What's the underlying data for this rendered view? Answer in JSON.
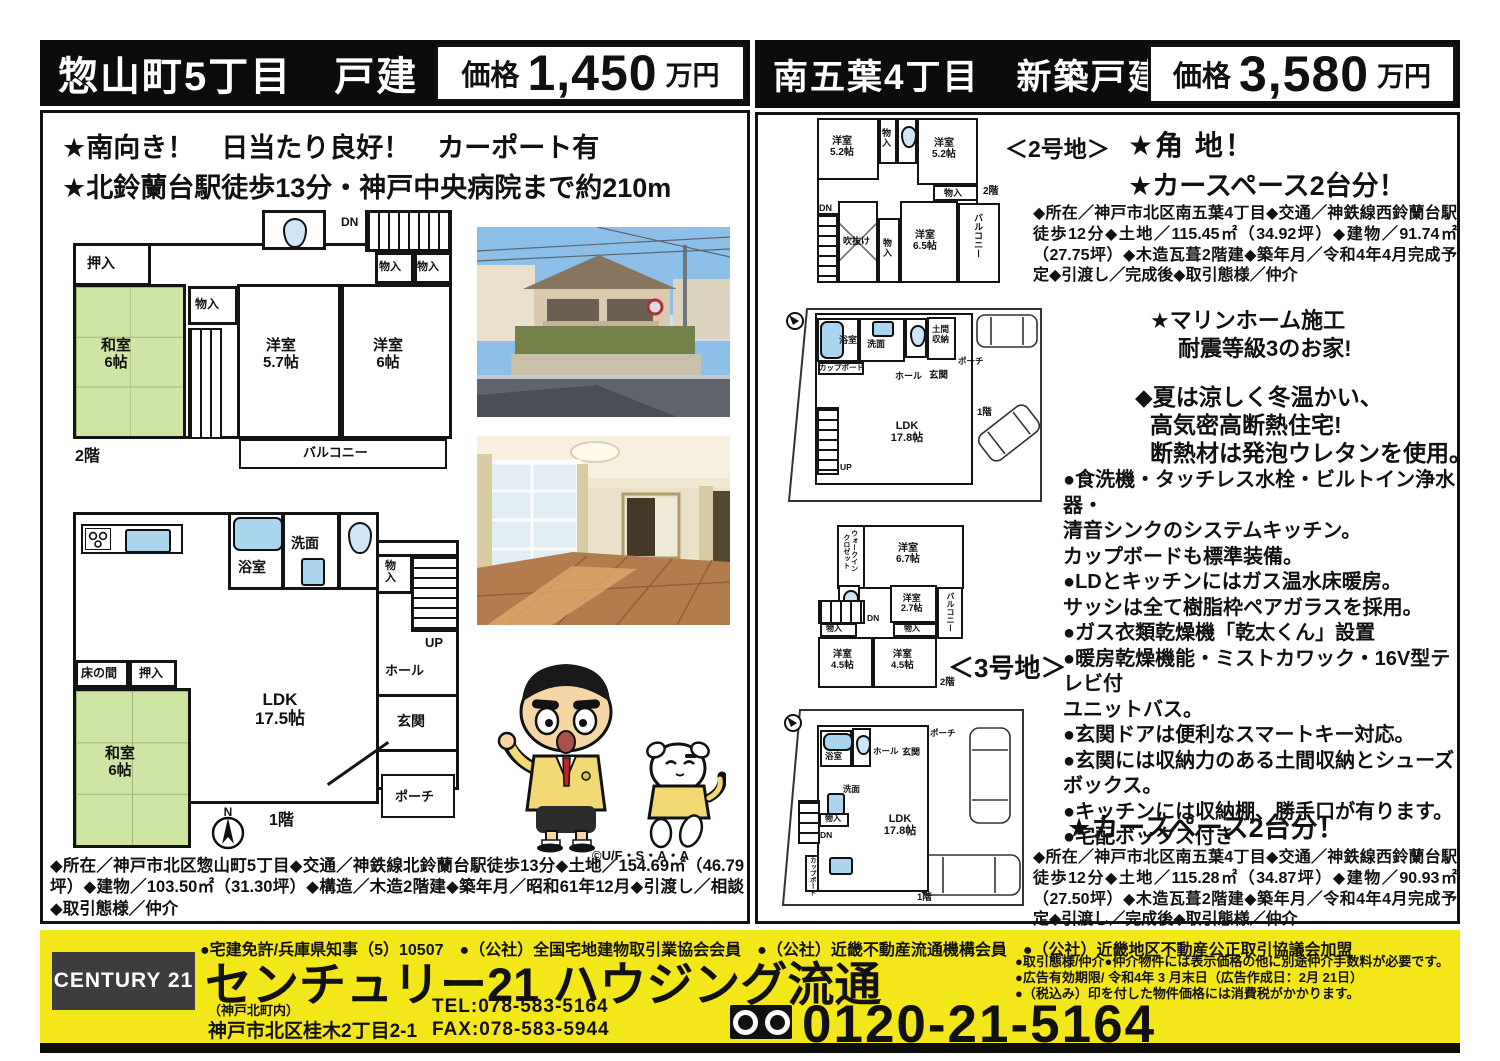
{
  "colors": {
    "accent_yellow": "#f3e71a",
    "header_black": "#0c0c0c",
    "tatami_green": "#cfe5a4",
    "fixture_blue": "#abd4ee"
  },
  "left": {
    "title": "惣山町5丁目　戸建",
    "price_label": "価格",
    "price_value": "1,450",
    "price_unit": "万円",
    "features": [
      "★南向き！　日当たり良好！　カーポート有",
      "★北鈴蘭台駅徒歩13分・神戸中央病院まで約210m"
    ],
    "details": "◆所在／神戸市北区惣山町5丁目◆交通／神鉄線北鈴蘭台駅徒歩13分◆土地／154.69㎡（46.79坪）◆建物／103.50㎡（31.30坪）◆構造／木造2階建◆築年月／昭和61年12月◆引渡し／相談◆取引態様／仲介",
    "copyright": "©U/F・S・A・A"
  },
  "right": {
    "title": "南五葉4丁目　新築戸建",
    "price_label": "価格",
    "price_value": "3,580",
    "price_unit": "万円",
    "lot2": "＜2号地＞",
    "lot3": "＜3号地＞",
    "headline_corner": "★角 地！",
    "headline_car": "★カースペース2台分！",
    "details_lot2": "◆所在／神戸市北区南五葉4丁目◆交通／神鉄線西鈴蘭台駅徒歩12分◆土地／115.45㎡（34.92坪）◆建物／91.74㎡（27.75坪）◆木造瓦葺2階建◆築年月／令和4年4月完成予定◆引渡し／完成後◆取引態様／仲介",
    "builder": [
      "★マリンホーム施工",
      "耐震等級3のお家!"
    ],
    "insulation": [
      "◆夏は涼しく冬温かい、",
      "高気密高断熱住宅!",
      "断熱材は発泡ウレタンを使用。"
    ],
    "bullets": [
      "●食洗機・タッチレス水栓・ビルトイン浄水器・",
      "清音シンクのシステムキッチン。",
      "カップボードも標準装備。",
      "●LDとキッチンにはガス温水床暖房。",
      "サッシは全て樹脂枠ペアガラスを採用。",
      "●ガス衣類乾燥機「乾太くん」設置",
      "●暖房乾燥機能・ミストカワック・16V型テレビ付",
      "ユニットバス。",
      "●玄関ドアは便利なスマートキー対応。",
      "●玄関には収納力のある土間収納とシューズ",
      "ボックス。",
      "●キッチンには収納棚、勝手口が有ります。",
      "●宅配ボックス付き"
    ],
    "headline_car2": "★カースペース2台分！",
    "details_lot3": "◆所在／神戸市北区南五葉4丁目◆交通／神鉄線西鈴蘭台駅徒歩12分◆土地／115.28㎡（34.87坪）◆建物／90.93㎡（27.50坪）◆木造瓦葺2階建◆築年月／令和4年4月完成予定◆引渡し／完成後◆取引態様／仲介"
  },
  "rooms": {
    "oshiire": "押入",
    "monoiri": "物入",
    "mono_v": "物\n入",
    "washitsu6": "和室\n6帖",
    "yo57": "洋室\n5.7帖",
    "yo6": "洋室\n6帖",
    "yo52": "洋室\n5.2帖",
    "yo65": "洋室\n6.5帖",
    "yo67": "洋室\n6.7帖",
    "yo27": "洋室\n2.7帖",
    "yo45": "洋室\n4.5帖",
    "balcony": "バルコニー",
    "dn": "DN",
    "up": "UP",
    "fukinuke": "吹抜け",
    "yokushitsu": "浴室",
    "senmen": "洗面",
    "hall": "ホール",
    "genkan": "玄関",
    "porch": "ポーチ",
    "tokonoma": "床の間",
    "doma": "土間\n収納",
    "cupboard": "カップボード",
    "wic": "ウォークイン\nクロゼット",
    "ldk175": "LDK\n17.5帖",
    "ldk178": "LDK\n17.8帖",
    "f1": "1階",
    "f2": "2階",
    "north": "N"
  },
  "footer": {
    "license": "●宅建免許/兵庫県知事（5）10507　●（公社）全国宅地建物取引業協会会員　●（公社）近畿不動産流通機構会員　●（公社）近畿地区不動産公正取引協議会加盟",
    "century": "CENTURY 21",
    "company": "センチュリー21 ハウジング流通",
    "branch": "（神戸北町内）",
    "address": "神戸市北区桂木2丁目2-1",
    "tel": "TEL:078-583-5164",
    "fax": "FAX:078-583-5944",
    "notes": [
      "●取引態様/仲介●仲介物件には表示価格の他に別途仲介手数料が必要です。",
      "●広告有効期限/ 令和4年 3 月末日（広告作成日：2月 21日）",
      "●（税込み）印を付した物件価格には消費税がかかります。"
    ],
    "phone": "0120-21-5164"
  }
}
